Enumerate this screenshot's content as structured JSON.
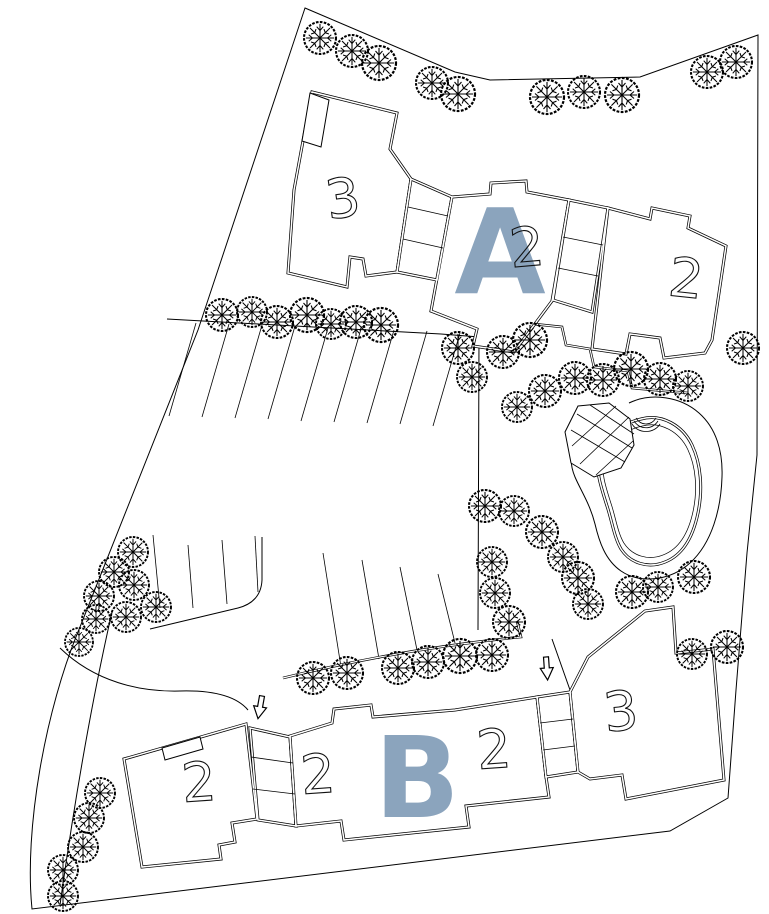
{
  "plan": {
    "type": "architectural-site-plan",
    "colors": {
      "background": "#ffffff",
      "linework": "#000000",
      "cluster_label_accent": "#8ba4bd"
    },
    "clusters": [
      {
        "name": "building-cluster-a",
        "label": "A",
        "units": [
          {
            "label": "3"
          },
          {
            "label": "2"
          },
          {
            "label": "2"
          }
        ]
      },
      {
        "name": "building-cluster-b",
        "label": "B",
        "units": [
          {
            "label": "2"
          },
          {
            "label": "2"
          },
          {
            "label": "2"
          },
          {
            "label": "3"
          }
        ]
      }
    ],
    "features": {
      "pool": "kidney-shaped pool with steps",
      "gazebo": "octagonal gazebo with lattice roof",
      "entry_arrow_count": 2,
      "tree_count": 62,
      "parking_stall_count": 17
    },
    "trees": [
      [
        320,
        38,
        16
      ],
      [
        352,
        51,
        16
      ],
      [
        379,
        63,
        17
      ],
      [
        432,
        83,
        16
      ],
      [
        458,
        94,
        17
      ],
      [
        547,
        97,
        17
      ],
      [
        584,
        92,
        16
      ],
      [
        622,
        95,
        17
      ],
      [
        707,
        72,
        16
      ],
      [
        736,
        62,
        16
      ],
      [
        222,
        315,
        16
      ],
      [
        252,
        312,
        15
      ],
      [
        277,
        322,
        16
      ],
      [
        307,
        315,
        17
      ],
      [
        331,
        324,
        15
      ],
      [
        356,
        322,
        16
      ],
      [
        381,
        325,
        17
      ],
      [
        458,
        348,
        16
      ],
      [
        472,
        377,
        15
      ],
      [
        503,
        352,
        16
      ],
      [
        530,
        340,
        17
      ],
      [
        517,
        407,
        15
      ],
      [
        545,
        391,
        16
      ],
      [
        575,
        378,
        16
      ],
      [
        603,
        380,
        16
      ],
      [
        631,
        369,
        17
      ],
      [
        660,
        379,
        16
      ],
      [
        688,
        386,
        15
      ],
      [
        743,
        348,
        16
      ],
      [
        485,
        506,
        16
      ],
      [
        514,
        511,
        15
      ],
      [
        542,
        532,
        16
      ],
      [
        563,
        557,
        15
      ],
      [
        492,
        562,
        15
      ],
      [
        495,
        593,
        15
      ],
      [
        509,
        622,
        16
      ],
      [
        578,
        578,
        16
      ],
      [
        588,
        604,
        15
      ],
      [
        632,
        592,
        16
      ],
      [
        658,
        587,
        15
      ],
      [
        694,
        577,
        16
      ],
      [
        692,
        654,
        15
      ],
      [
        727,
        647,
        16
      ],
      [
        313,
        678,
        16
      ],
      [
        347,
        673,
        16
      ],
      [
        398,
        668,
        16
      ],
      [
        428,
        662,
        16
      ],
      [
        460,
        656,
        17
      ],
      [
        492,
        655,
        16
      ],
      [
        133,
        552,
        15
      ],
      [
        114,
        572,
        15
      ],
      [
        134,
        585,
        15
      ],
      [
        99,
        596,
        15
      ],
      [
        156,
        607,
        15
      ],
      [
        126,
        617,
        15
      ],
      [
        96,
        619,
        14
      ],
      [
        79,
        642,
        14
      ],
      [
        100,
        793,
        15
      ],
      [
        89,
        818,
        15
      ],
      [
        83,
        847,
        15
      ],
      [
        63,
        870,
        15
      ],
      [
        63,
        896,
        15
      ]
    ],
    "parking": {
      "upper": [
        [
          196,
          323,
          169,
          416
        ],
        [
          229,
          324,
          202,
          417
        ],
        [
          262,
          325,
          235,
          418
        ],
        [
          295,
          326,
          268,
          419
        ],
        [
          328,
          328,
          301,
          421
        ],
        [
          361,
          329,
          334,
          422
        ],
        [
          394,
          330,
          367,
          423
        ],
        [
          427,
          331,
          400,
          424
        ],
        [
          460,
          333,
          433,
          426
        ]
      ],
      "lower_left": [
        [
          153,
          535,
          160,
          608
        ],
        [
          188,
          545,
          193,
          608
        ],
        [
          222,
          540,
          227,
          604
        ],
        [
          255,
          536,
          258,
          592
        ]
      ],
      "lower_right": [
        [
          323,
          553,
          341,
          667
        ],
        [
          362,
          560,
          379,
          659
        ],
        [
          400,
          567,
          417,
          650
        ],
        [
          438,
          574,
          455,
          643
        ]
      ]
    },
    "arrows": [
      {
        "x": 262,
        "y": 696,
        "rotate": 10
      },
      {
        "x": 546,
        "y": 657,
        "rotate": -4
      }
    ]
  }
}
